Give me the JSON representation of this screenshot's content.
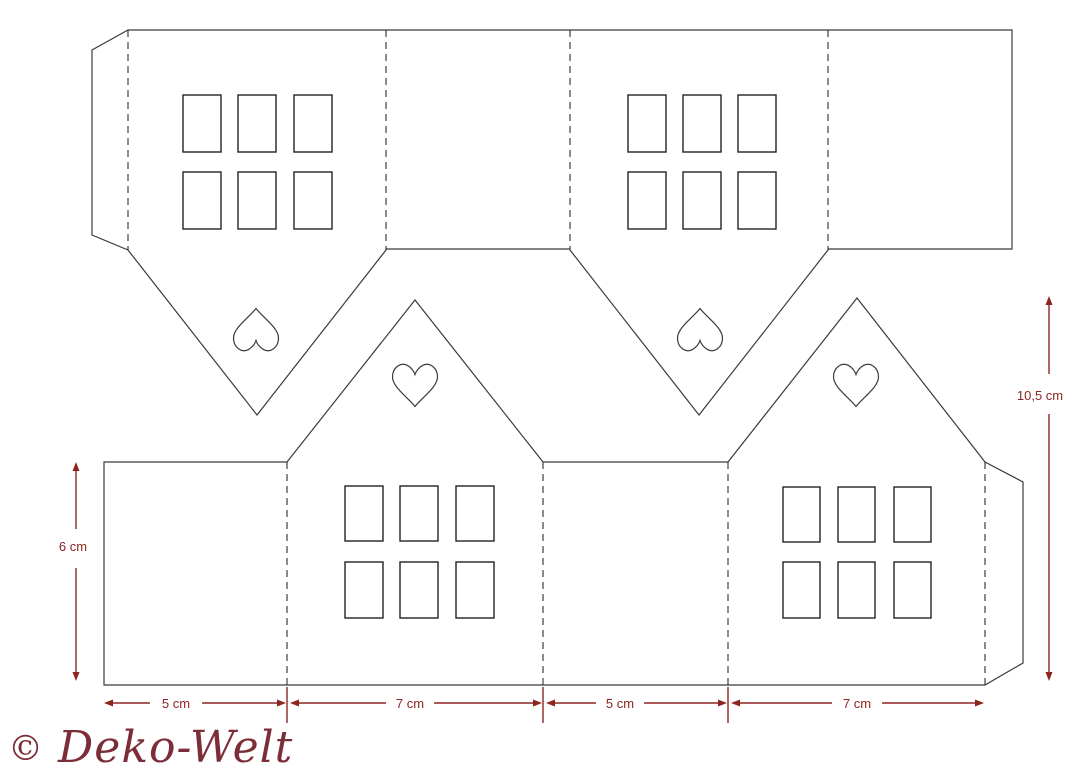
{
  "figure": {
    "kind": "papercraft house template",
    "hearts_count": 4,
    "window_panes_per_wall": 6
  },
  "colors": {
    "background": "#ffffff",
    "outline": "#3b3b3b",
    "fold": "#2e2e2e",
    "dimension": "#8e2420",
    "watermark": "#7b2e38"
  },
  "dimensions": {
    "left_height": {
      "label": "6 cm"
    },
    "right_height": {
      "label": "10,5 cm"
    },
    "bottom_widths": [
      {
        "label": "5 cm"
      },
      {
        "label": "7 cm"
      },
      {
        "label": "5 cm"
      },
      {
        "label": "7 cm"
      }
    ]
  },
  "watermark": {
    "copyright_symbol": "©",
    "brand": "Deko-Welt"
  }
}
